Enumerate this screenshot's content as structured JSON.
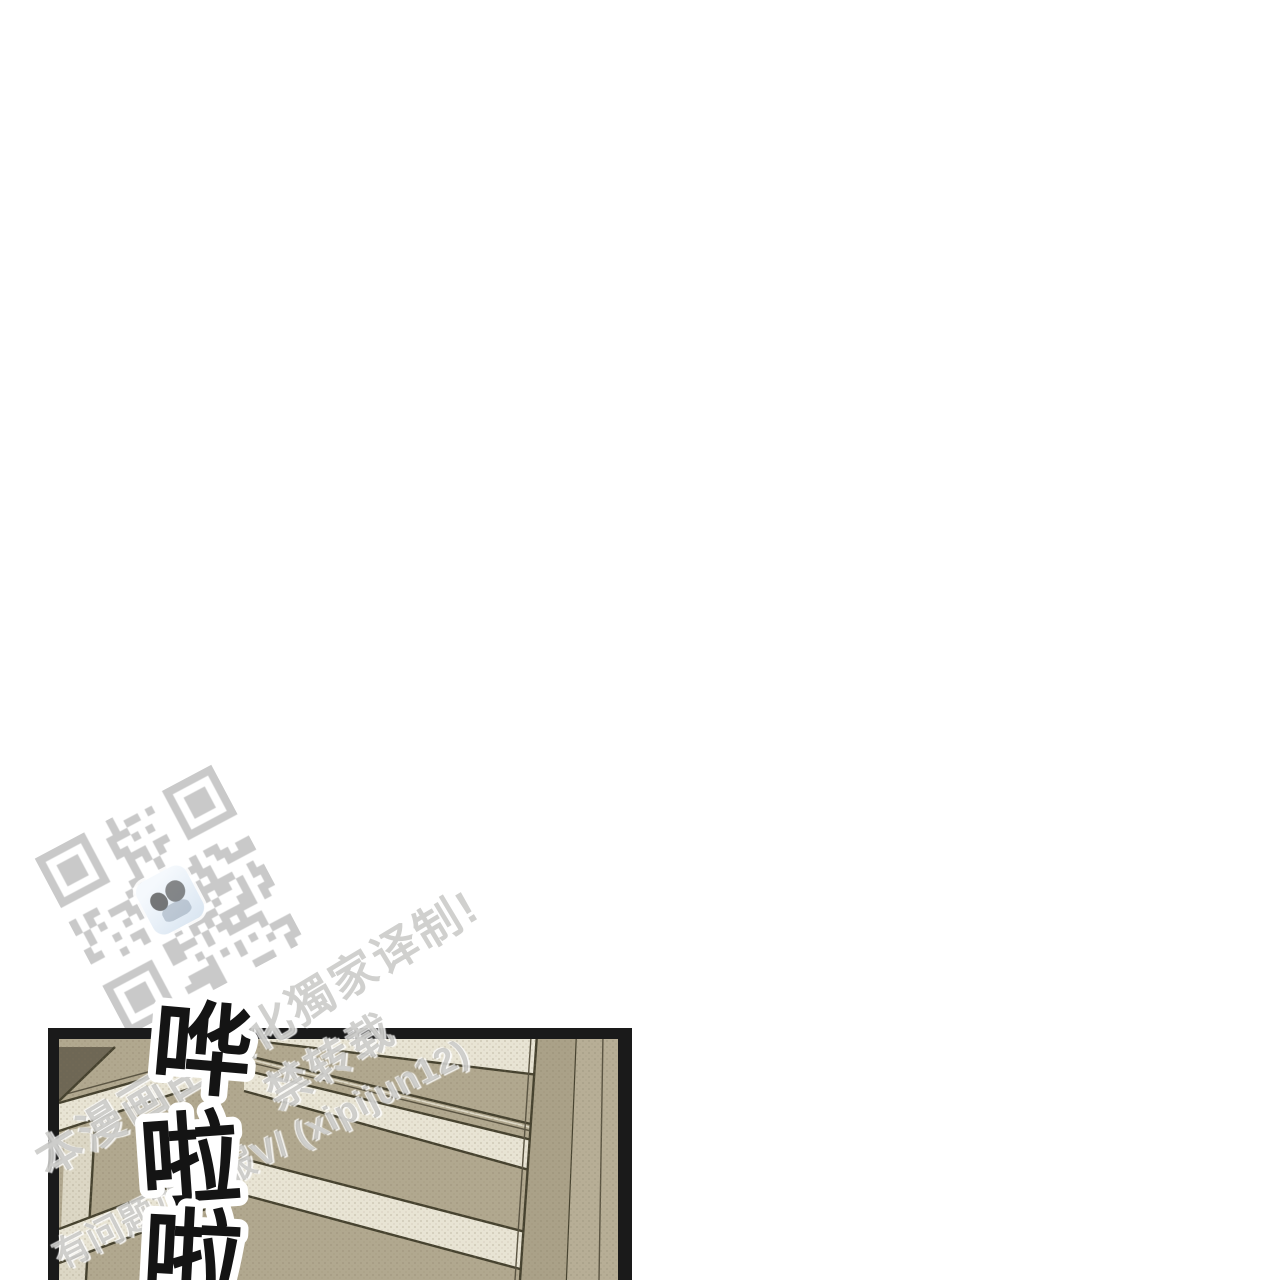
{
  "page": {
    "background": "#ffffff"
  },
  "qr": {
    "name": "group-contact-qr-code",
    "module_color": "#c9c9c9",
    "icon_colors": {
      "bg1": "#f5f9fd",
      "bg2": "#d9e5f1",
      "hair": "#4b4b4b"
    }
  },
  "watermark": {
    "color": "#9a9a9a",
    "line1": "本漫画由汉化獨家译制!",
    "line2": "禁转载",
    "line3": "有问题加客服V/ (xipijun12)"
  },
  "sfx": {
    "text": "哗啦啦",
    "chars": [
      "哗",
      "啦",
      "啦"
    ],
    "fill": "#141414",
    "outline": "#ffffff"
  },
  "panel": {
    "border_color": "#1a1a1a",
    "colors": {
      "tan": "#b1a88f",
      "cream": "#e8e4d4",
      "dark_line": "#46422f",
      "shadow_wedge": "#6e6755",
      "jamb": "#dcd7c5"
    }
  }
}
